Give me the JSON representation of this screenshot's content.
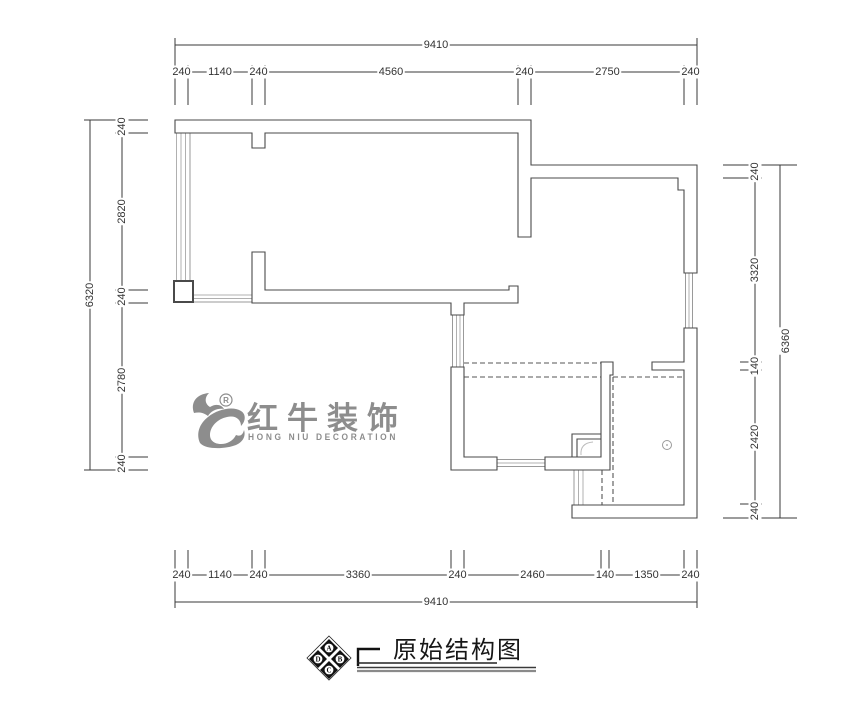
{
  "drawing": {
    "title": "原始结构图",
    "compass": {
      "letters": [
        "A",
        "B",
        "C",
        "D"
      ]
    },
    "logo": {
      "cn": "红牛装饰",
      "en": "HONG NIU DECORATION",
      "reg": "R"
    },
    "dims": {
      "top_total": "9410",
      "top": [
        "240",
        "1140",
        "240",
        "4560",
        "240",
        "2750",
        "240"
      ],
      "bottom": [
        "240",
        "1140",
        "240",
        "3360",
        "240",
        "2460",
        "140",
        "1350",
        "240"
      ],
      "bottom_total": "9410",
      "left_total": "6320",
      "left": [
        "240",
        "2820",
        "240",
        "2780",
        "240"
      ],
      "right": [
        "240",
        "3320",
        "140",
        "2420",
        "240"
      ],
      "right_total": "6360"
    },
    "colors": {
      "wall_line": "#4a4a4a",
      "dim_line": "#3a3a3a",
      "window_line": "#b0b0b0",
      "dashed_line": "#555555",
      "logo_gray": "#8d8d8d"
    }
  }
}
